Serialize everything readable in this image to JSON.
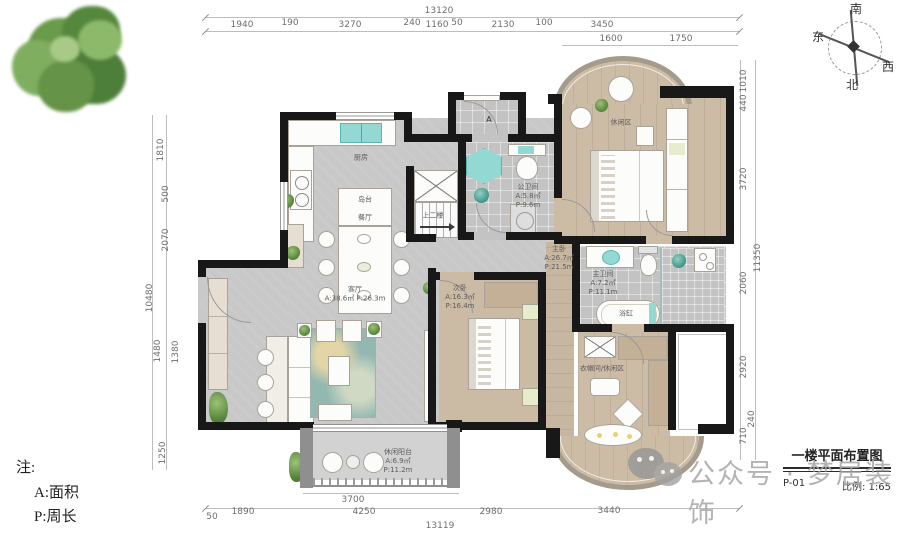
{
  "compass": {
    "south": "南",
    "east": "东",
    "west": "西",
    "north": "北"
  },
  "note": {
    "head": "注:",
    "line_a": "A:面积",
    "line_p": "P:周长"
  },
  "watermark": {
    "text": "公众号 · 梦居装饰"
  },
  "titleblock": {
    "title": "一楼平面布置图",
    "sheet": "P-01",
    "scale": "比例: 1:65"
  },
  "dims": {
    "top": {
      "total": "13120",
      "s0": "1940",
      "s1": "190",
      "s2": "3270",
      "s3": "240",
      "s4": "1160",
      "s5": "50",
      "s6": "2130",
      "s7": "100",
      "s8": "3450",
      "sub0": "1600",
      "sub1": "1750"
    },
    "left": {
      "total": "10480",
      "s0": "1810",
      "s1": "500",
      "s2": "2070",
      "s3": "1480",
      "s4": "1380",
      "s5": "1250"
    },
    "right": {
      "total": "11350",
      "s0": "1010",
      "s1": "440",
      "s2": "3720",
      "s3": "2060",
      "s4": "2920",
      "s5": "240",
      "s6": "710"
    },
    "bottom": {
      "balcony": "3700",
      "s0": "50",
      "s1": "1890",
      "s2": "4250",
      "s3": "2980",
      "s4": "3440",
      "total": "13119"
    }
  },
  "rooms": {
    "kitchen": {
      "name": "厨房"
    },
    "island": {
      "name": "岛台"
    },
    "dining": {
      "name": "餐厅"
    },
    "stairs": {
      "name": "上二楼"
    },
    "living": {
      "name": "客厅",
      "ap": "A:38.6㎡ P:26.3m"
    },
    "guestbath": {
      "name": "公卫间",
      "a": "A:5.8㎡",
      "p": "P:9.6m"
    },
    "master": {
      "name": "主卧",
      "a": "A:26.7㎡",
      "p": "P:21.5m"
    },
    "masterbath": {
      "name": "主卫间",
      "a": "A:7.2㎡",
      "p": "P:11.1m"
    },
    "tub": {
      "name": "浴缸"
    },
    "leisure": {
      "name": "休闲区"
    },
    "bed2": {
      "name": "次卧",
      "a": "A:16.3㎡",
      "p": "P:16.4m"
    },
    "closet": {
      "name": "衣帽间/休闲区"
    },
    "balcony": {
      "name": "休闲阳台",
      "a": "A:6.9㎡",
      "p": "P:11.2m"
    },
    "entry_mark": "A"
  }
}
